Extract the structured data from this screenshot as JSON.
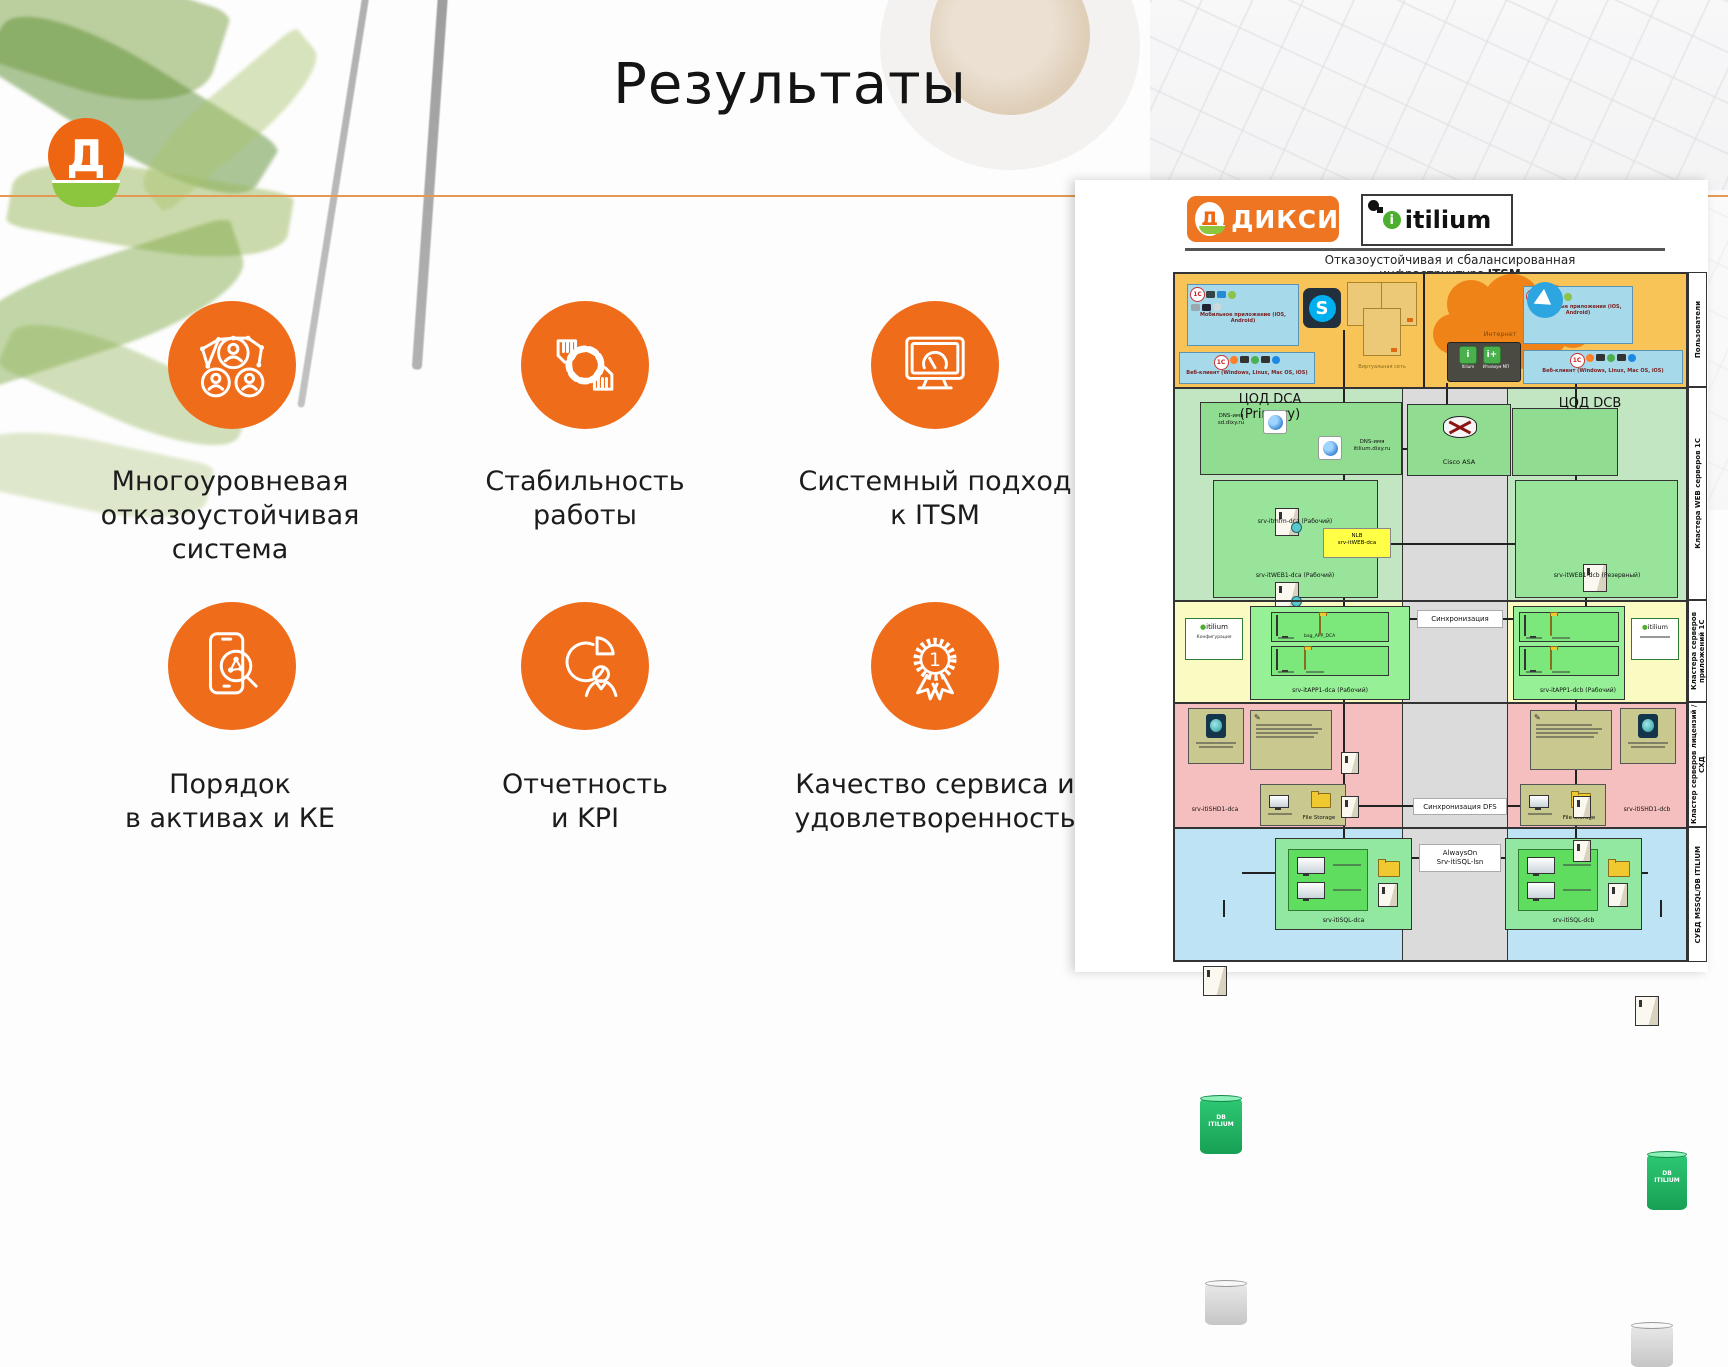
{
  "slide": {
    "title": "Результаты",
    "logo_letter": "Д"
  },
  "features": [
    {
      "icon": "network-users-icon",
      "label": "Многоуровневая\nотказоустойчивая\nсистема"
    },
    {
      "icon": "hands-ring-icon",
      "label": "Стабильность\nработы"
    },
    {
      "icon": "monitor-gauge-icon",
      "label": "Системный подход\nк ITSM"
    },
    {
      "icon": "phone-search-icon",
      "label": "Порядок\nв активах и КЕ"
    },
    {
      "icon": "pie-person-icon",
      "label": "Отчетность\nи KPI"
    },
    {
      "icon": "award-medal-icon",
      "label": "Качество сервиса и\nудовлетворенность"
    }
  ],
  "diagram": {
    "dixy_logo": {
      "letter": "Д",
      "text": "ДИКСИ"
    },
    "itilium_logo": {
      "i": "i",
      "text": "itilium"
    },
    "title": {
      "line1": "Отказоустойчивая и сбалансированная",
      "line2_prefix": "инфраструктура",
      "line2_bold": "ITSM"
    },
    "clients_left": {
      "one_c": "1С",
      "mobile_caption": "Мобильное приложение (iOS, Android)",
      "web_caption": "Веб-клиент (Windows, Linux, Mac OS, iOS)",
      "network_caption": "Виртуальная сеть"
    },
    "clients_right": {
      "one_c": "1С",
      "internet": "Интернет",
      "app1": "Itilium",
      "app2": "Итилиум МП",
      "mobile_caption": "Мобильные приложения (iOS, Android)",
      "web_caption": "Веб-клиент (Windows, Linux, Mac OS, iOS)"
    },
    "zones": {
      "dca_title": "ЦОД DCA\n(Primary)",
      "dcb_title": "ЦОД DCB",
      "dns1": "DNS-имя\nsd.dixy.ru",
      "dns2": "DNS-имя\nitilium.dixy.ru",
      "cisco": "Cisco ASA",
      "nlb": "NLB\nsrv-itWEB-dca",
      "web_mgmt_server": "srv-itmfm-dca (Рабочий)",
      "web_server_dca": "srv-itWEB1-dca (Рабочий)",
      "web_server_dcb": "srv-itWEB1-dcb (Резервный)",
      "itilium_cfg_logo": "itilium",
      "itilium_cfg_caption": "Конфигурация",
      "folder1": "bag_APP_DCA",
      "app_server_dca": "srv-itAPP1-dca (Рабочий)",
      "app_server_dcb": "srv-itAPP1-dcb (Рабочий)",
      "sync": "Синхронизация",
      "sync_dfs": "Синхронизация DFS",
      "shd_server_dca": "srv-itiSHD1-dca",
      "shd_server_dcb": "srv-itiSHD1-dcb",
      "file_storage": "File Storage",
      "db_label": "DB\nITILIUM",
      "sql_server_dca": "srv-itiSQL-dca",
      "sql_server_dcb": "srv-itiSQL-dcb",
      "always_on": "AlwaysOn\nSrv-itiSQL-lsn"
    },
    "side_labels": [
      "Пользователи",
      "Кластера WEB серверов 1С",
      "Кластера серверов приложений 1С",
      "Кластер серверов лицензий /СХД",
      "СУБД MSSQL/DB ITILIUM"
    ]
  }
}
